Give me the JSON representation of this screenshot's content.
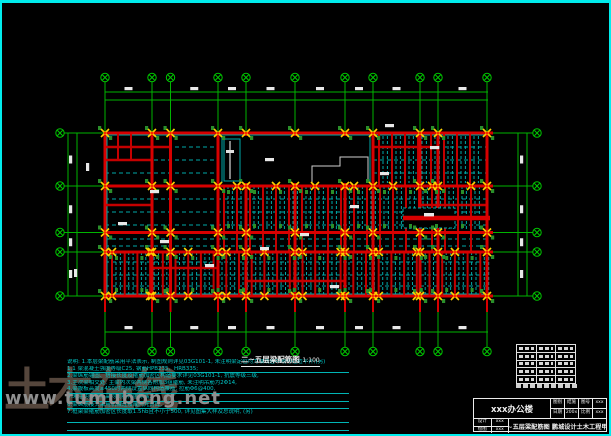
{
  "page": {
    "background": "#000000",
    "border_color": "#00ecec"
  },
  "drawing": {
    "title": "二~五层梁配筋图",
    "scale": "1:100",
    "colors": {
      "grid_green": "#00b400",
      "beam_red": "#d80000",
      "secondary_cyan": "#00a8a8",
      "column_green": "#2a8f2a",
      "joint_yellow": "#ffd200",
      "dim_text_white": "#e8e8e8"
    }
  },
  "notes": {
    "lines": [
      "说明: 1.本层梁配筋采用平法表示, 制图规则详见03G101-1, 未注明梁定位均为轴线居中或与柱边平齐;(另)",
      "1.1 梁混凝土强度等级C25, 钢筋HPB235、HRB335;",
      "2.梁纵筋锚固、搭接长度及箍筋加密区构造要求详见03G101-1, 抗震等级三级,",
      "3.主次梁相交处, 主梁内次梁两侧各附加3组箍筋, 未注明吊筋为2Φ14,",
      "4.梁腹板高度≥450时两侧设置纵向构造腰筋, 拉筋Φ6@400,",
      "5.未注明梁顶标高均同结构层标高,",
      "6.梁纵筋接头采用机械连接或闪光对焊,",
      "7.框架梁箍筋加密区长度取1.5hb且不小于500, 详见图集大样及总说明, (另)",
      "",
      "",
      ""
    ]
  },
  "watermark": {
    "logo_text": "土木在线",
    "url_text": "www.tumubong.net"
  },
  "title_block": {
    "project": "xxx办公楼",
    "fields": [
      {
        "label": "图别",
        "value": "结施"
      },
      {
        "label": "图号",
        "value": "xxx"
      },
      {
        "label": "日期",
        "value": "200x"
      },
      {
        "label": "比例",
        "value": "xxx"
      }
    ],
    "designer_label": "设计",
    "designer_value": "xxx",
    "drafter_label": "绘图",
    "drafter_value": "xxx",
    "sheet_title": "二~五层梁配筋图 鹏城设计土木工程甲级"
  }
}
